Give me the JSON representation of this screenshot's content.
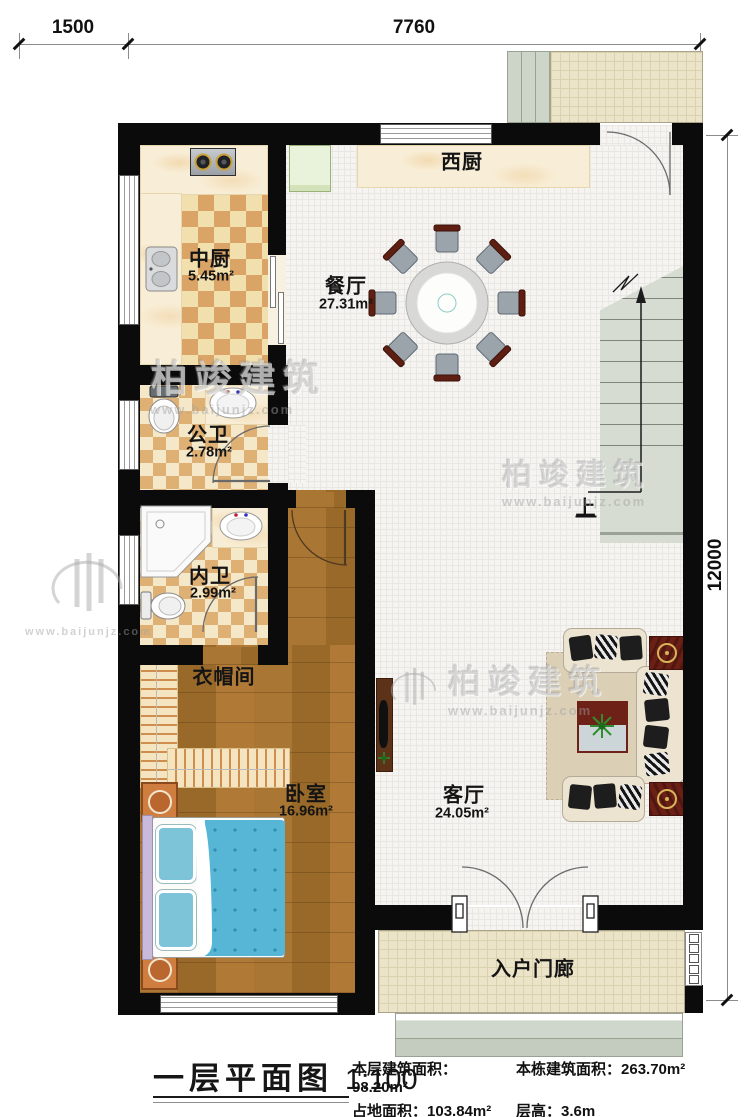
{
  "dimensions": {
    "top_left": "1500",
    "top_span": "7760",
    "right": "12000"
  },
  "rooms": {
    "west_kitchen": {
      "name": "西厨"
    },
    "main_kitchen": {
      "name": "中厨",
      "area": "5.45m²"
    },
    "dining": {
      "name": "餐厅",
      "area": "27.31m²"
    },
    "public_bath": {
      "name": "公卫",
      "area": "2.78m²"
    },
    "private_bath": {
      "name": "内卫",
      "area": "2.99m²"
    },
    "cloakroom": {
      "name": "衣帽间"
    },
    "bedroom": {
      "name": "卧室",
      "area": "16.96m²"
    },
    "living": {
      "name": "客厅",
      "area": "24.05m²"
    },
    "porch": {
      "name": "入户门廊"
    },
    "stairs": {
      "up_label": "上"
    }
  },
  "title": {
    "name": "一层平面图",
    "scale": "1:100"
  },
  "stats": {
    "items": [
      {
        "label": "本层建筑面积：",
        "value": "98.20m²"
      },
      {
        "label": "本栋建筑面积：",
        "value": "263.70m²"
      },
      {
        "label": "占地面积：",
        "value": "103.84m²"
      },
      {
        "label": "层高：",
        "value": "3.6m"
      }
    ]
  },
  "watermark": {
    "brand": "柏竣建筑",
    "url": "www.baijunjz.com"
  },
  "colors": {
    "wall": "#0b0b0b",
    "wood": "#a4702d",
    "checker": "#d9a466",
    "tile": "#f5f4f1",
    "stair": "#d4dbd0",
    "accent_red": "#6b1f15",
    "bed_blue": "#57b5d6"
  }
}
